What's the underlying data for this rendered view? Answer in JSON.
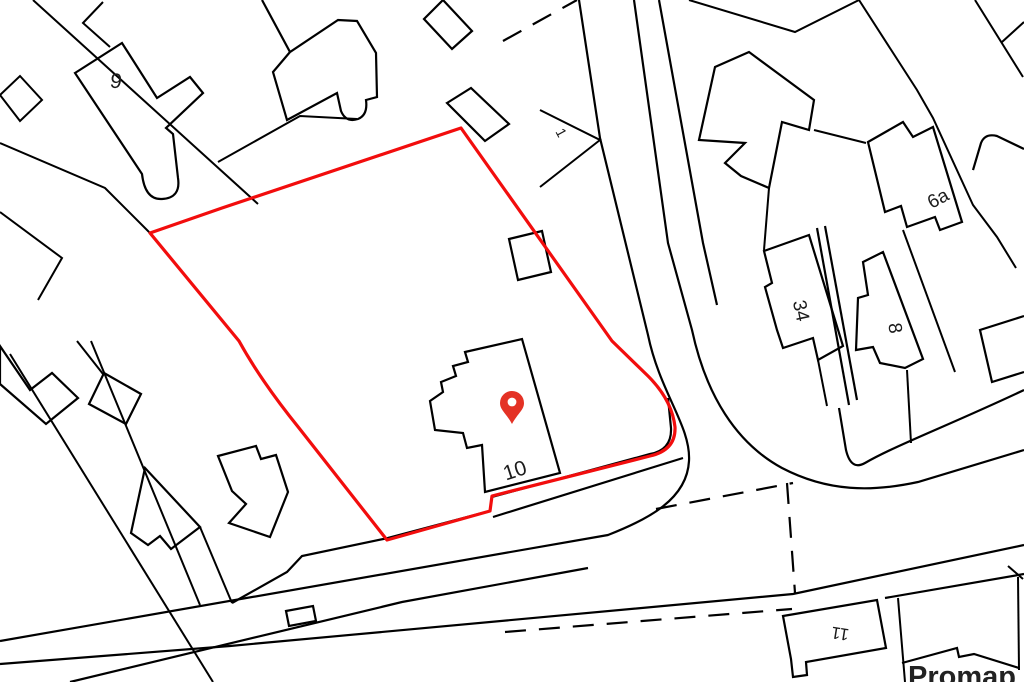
{
  "map": {
    "type": "site-location-plan",
    "background_color": "#ffffff",
    "linework_color": "#000000",
    "boundary_color": "#f20d0d",
    "pin_color": "#e43225",
    "pin": {
      "x": 512,
      "y": 424
    },
    "labels": [
      {
        "text": "9",
        "x": 115,
        "y": 88,
        "rotation": 8,
        "size": 21
      },
      {
        "text": "1",
        "x": 557,
        "y": 135,
        "rotation": 62,
        "size": 14
      },
      {
        "text": "6a",
        "x": 941,
        "y": 204,
        "rotation": -28,
        "size": 19
      },
      {
        "text": "34",
        "x": 795,
        "y": 312,
        "rotation": 78,
        "size": 19
      },
      {
        "text": "8",
        "x": 889,
        "y": 329,
        "rotation": 82,
        "size": 19
      },
      {
        "text": "10",
        "x": 517,
        "y": 477,
        "rotation": -18,
        "size": 21
      },
      {
        "text": "11",
        "x": 841,
        "y": 628,
        "rotation": 189,
        "size": 17
      }
    ],
    "watermark": {
      "text": "Promap",
      "x": 908,
      "y": 686,
      "size": 29,
      "color": "#222222"
    }
  }
}
